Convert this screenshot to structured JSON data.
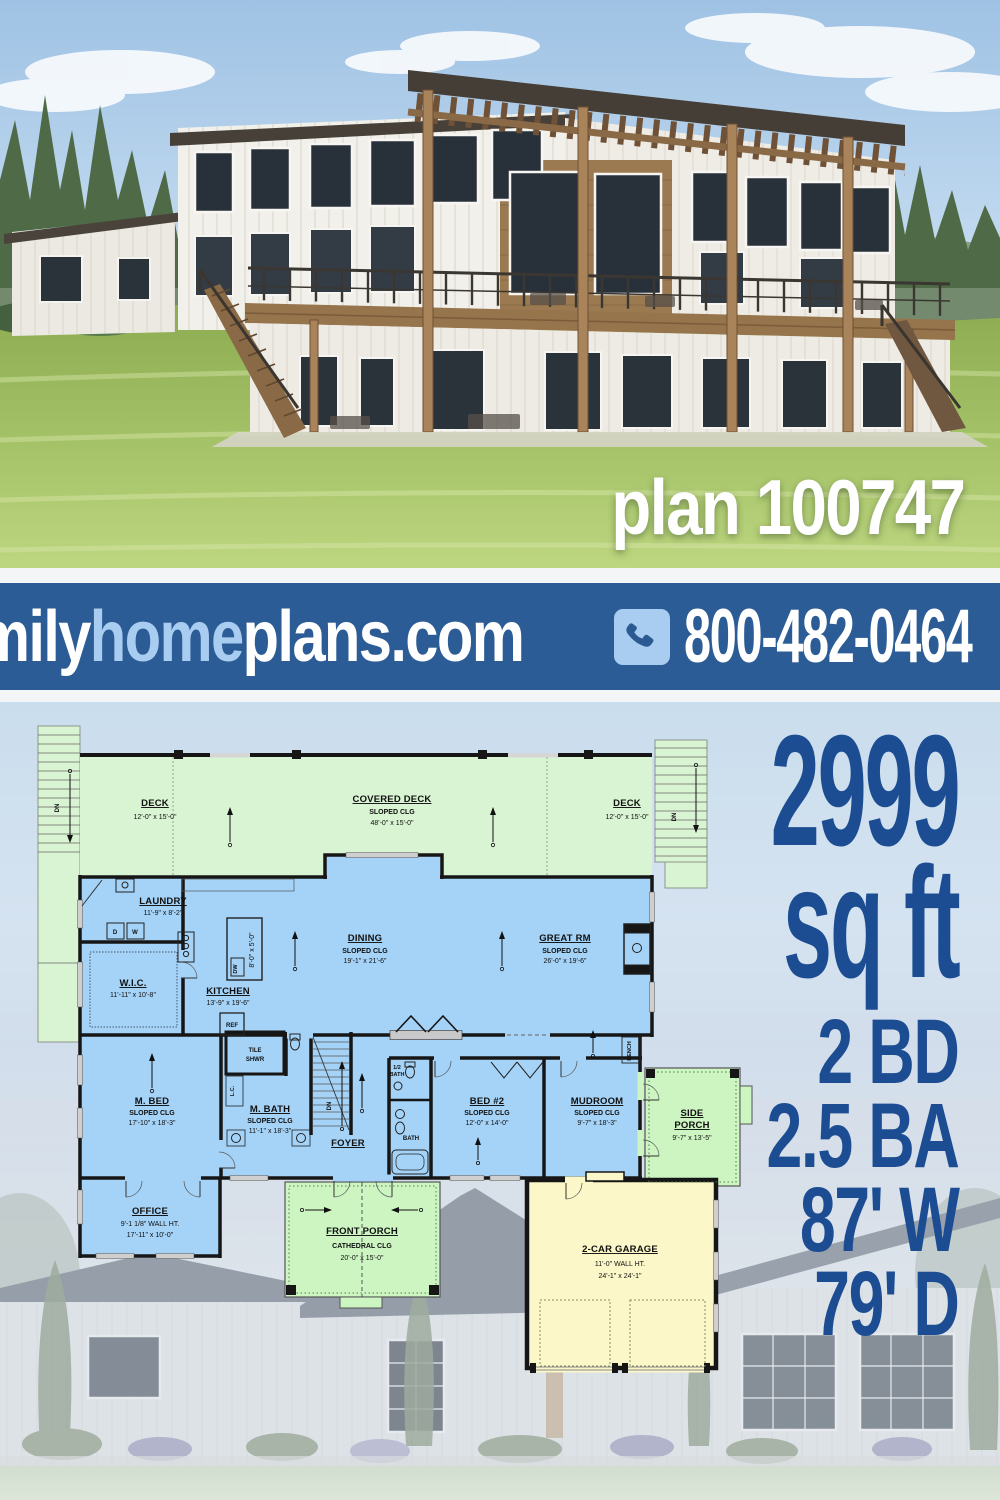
{
  "photo": {
    "plan_label": "plan 100747"
  },
  "banner": {
    "brand": {
      "family": "family",
      "home": "home",
      "plans": "plans.com"
    },
    "phone": "800-482-0464",
    "phone_icon": "phone-handset-icon"
  },
  "stats": {
    "sqft_value": "2999",
    "sqft_unit": "sq ft",
    "beds": "2 BD",
    "baths": "2.5 BA",
    "width": "87' W",
    "depth": "79' D"
  },
  "colors": {
    "banner_bg": "#2c5c96",
    "banner_home": "#a9cdf0",
    "stats_blue": "#1c4d92",
    "deck_green": "#d9f4d2",
    "room_blue": "#a5d3f8",
    "garage_yellow": "#fbf7c8"
  },
  "floor_plan": {
    "rooms": {
      "deck_left": {
        "name": "DECK",
        "dims": "12'-0\" x 15'-0\""
      },
      "covered_deck": {
        "name": "COVERED DECK",
        "ceiling": "SLOPED CLG",
        "dims": "48'-0\" x 15'-0\""
      },
      "deck_right": {
        "name": "DECK",
        "dims": "12'-0\" x 15'-0\""
      },
      "laundry": {
        "name": "LAUNDRY",
        "dims": "11'-9\" x 8'-2\""
      },
      "wic": {
        "name": "W.I.C.",
        "dims": "11'-11\" x 10'-8\""
      },
      "kitchen": {
        "name": "KITCHEN",
        "dims": "13'-9\" x 19'-6\""
      },
      "island": {
        "dims": "8'-0\" x 5'-0\""
      },
      "dining": {
        "name": "DINING",
        "ceiling": "SLOPED CLG",
        "dims": "19'-1\" x 21'-6\""
      },
      "great_rm": {
        "name": "GREAT RM",
        "ceiling": "SLOPED CLG",
        "dims": "26'-0\" x 19'-6\""
      },
      "m_bed": {
        "name": "M. BED",
        "ceiling": "SLOPED CLG",
        "dims": "17'-10\" x 18'-3\""
      },
      "tile_shwr": {
        "line1": "TILE",
        "line2": "SHWR"
      },
      "m_bath": {
        "name": "M. BATH",
        "ceiling": "SLOPED CLG",
        "dims": "11'-1\" x 18'-3\""
      },
      "lc": {
        "name": "L.C."
      },
      "foyer": {
        "name": "FOYER"
      },
      "half_bath": {
        "line1": "1/2",
        "line2": "BATH"
      },
      "bed2": {
        "name": "BED #2",
        "ceiling": "SLOPED CLG",
        "dims": "12'-0\" x 14'-0\""
      },
      "bath": {
        "name": "BATH"
      },
      "mudroom": {
        "name": "MUDROOM",
        "ceiling": "SLOPED CLG",
        "dims": "9'-7\" x 18'-3\""
      },
      "bench": {
        "name": "BENCH"
      },
      "side_porch": {
        "line1": "SIDE",
        "line2": "PORCH",
        "dims": "9'-7\" x 13'-5\""
      },
      "office": {
        "name": "OFFICE",
        "wall": "9'-1 1/8\" WALL HT.",
        "dims": "17'-11\" x 10'-0\""
      },
      "front_porch": {
        "name": "FRONT PORCH",
        "ceiling": "CATHEDRAL CLG",
        "dims": "20'-0\" x 15'-0\""
      },
      "garage": {
        "name": "2-CAR GARAGE",
        "wall": "11'-0\" WALL HT.",
        "dims": "24'-1\" x 24'-1\""
      }
    },
    "labels": {
      "dn": "DN",
      "dw": "DW",
      "ref": "REF",
      "washer": "W",
      "dryer": "D"
    }
  }
}
